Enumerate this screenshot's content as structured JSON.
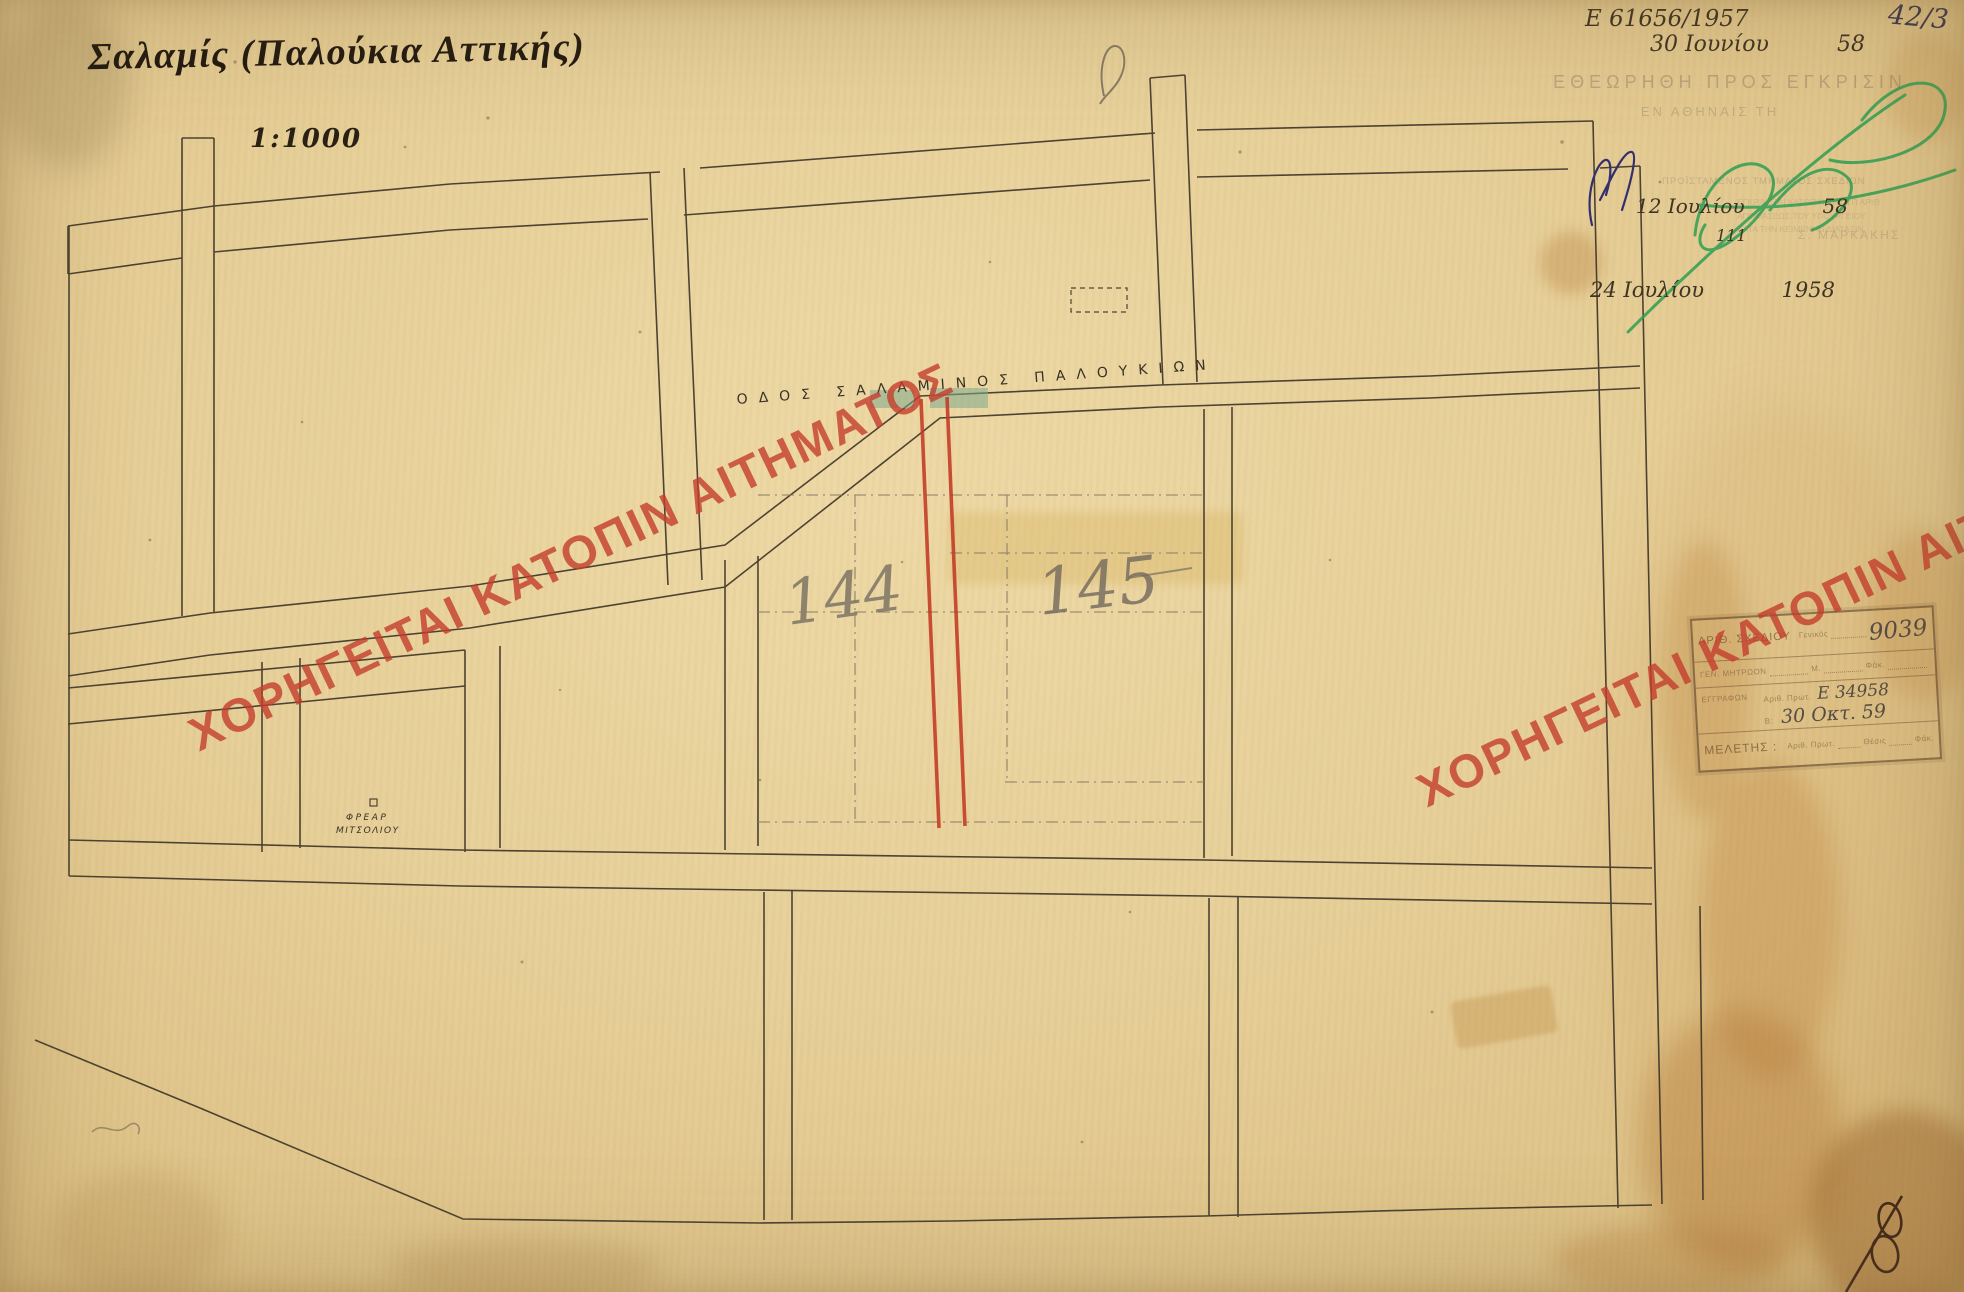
{
  "header": {
    "title": "Σαλαμίς (Παλούκια Αττικής)",
    "scale": "1:1000"
  },
  "top_right": {
    "file_number": "Ε 61656/1957",
    "sheet_code": "42/3",
    "approval_stamp_line1": "ΕΘΕΩΡΗΘΗ ΠΡΟΣ ΕΓΚΡΙΣΙΝ",
    "approval_stamp_line2": "ΕΝ ΑΘΗΝΑΙΣ ΤΗ",
    "date1_text": "30 Ιουνίου",
    "date1_year": "58",
    "date2_text": "12 Ιουλίου",
    "date2_year": "58",
    "date2_note": "111",
    "date3_text": "24 Ιουλίου",
    "date3_year": "1958",
    "faint_title": "ΠΡΟΪΣΤΑΜΕΝΟΣ ΤΜΗΜΑΤΟΣ ΣΧΕΔΙΩΝ",
    "faint_name": "Σ. ΜΑΡΚΑΚΗΣ",
    "faint_note1": "ΕΓΚΡΙΝΕΤΑΙ ΚΑΤΟΠΙΝ ΤΗΣ ΥΠ ΑΡΙΘ.",
    "faint_note2": "ΑΠΟΦΑΣΕΩΣ ΤΟΥ ΥΠΟΥΡΓΕΙΟΥ",
    "faint_note3": "ΚΑΤΑ ΤΗΝ ΚΕΙΜΕΝΗΝ ΔΙΑΤΑΞΙΝ"
  },
  "map": {
    "street_label": "ΟΔΟΣ ΣΑΛΑΜΙΝΟΣ ΠΑΛΟΥΚΙΩΝ",
    "block_144": "144",
    "block_145": "145",
    "well_label_line1": "ΦΡΕΑΡ",
    "well_label_line2": "ΜΙΤΣΟΛΙΟΥ"
  },
  "watermark": {
    "text": "ΧΟΡΗΓΕΙΤΑΙ ΚΑΤΟΠΙΝ ΑΙΤΗΜΑΤΟΣ",
    "color": "#c33d2c"
  },
  "colors": {
    "paper": "#e7d099",
    "ink_lines": "#3d3427",
    "red_street": "#c23a24",
    "teal_patch": "#7daa8c",
    "green_signature": "#2f9e53"
  },
  "stamp_box": {
    "drawing_no_label": "ΑΡΙΘ. ΣΧΕΔΙΟΥ",
    "general_label": "Γενικός",
    "drawing_no_value": "9039",
    "registry_label": "ΓΕΝ. ΜΗΤΡΩΟΝ",
    "m_label": "Μ.",
    "fak_label": "Φάκ.",
    "documents_label": "ΕΓΓΡΑΦΩΝ",
    "protocol_label": "Αριθ. Πρωτ.",
    "protocol_value": "Ε 34958",
    "b_label": "Β:",
    "date_value": "30 Οκτ. 59",
    "study_label": "ΜΕΛΕΤΗΣ :",
    "position_label": "Θέσις",
    "fak2_label": "Φάκ."
  }
}
